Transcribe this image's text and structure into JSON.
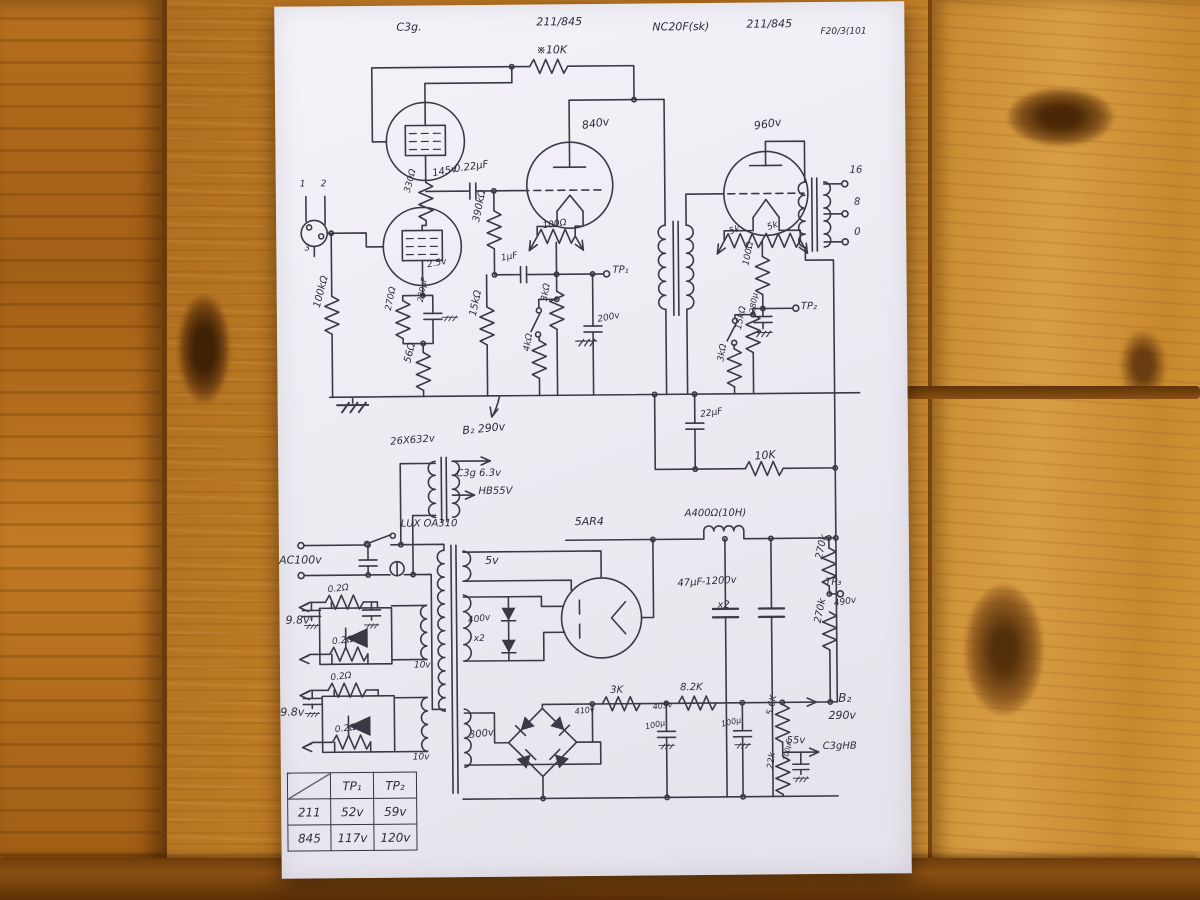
{
  "scene": {
    "description": "hand-drawn tube amplifier schematic on paper on wooden table",
    "wood_color": "#b06c1c",
    "paper_color": "#f2f1f6",
    "ink_color": "#3a3946"
  },
  "schematic": {
    "labels": [
      {
        "t": "C3g.",
        "x": 122,
        "y": 16
      },
      {
        "t": "211/845",
        "x": 262,
        "y": 12
      },
      {
        "t": "NC20F(sk)",
        "x": 378,
        "y": 18
      },
      {
        "t": "211/845",
        "x": 472,
        "y": 16
      },
      {
        "t": "F20/3(101",
        "x": 546,
        "y": 26,
        "s": 9
      },
      {
        "t": "※10K",
        "x": 262,
        "y": 40
      },
      {
        "t": "840v",
        "x": 306,
        "y": 116,
        "r": -8
      },
      {
        "t": "960v",
        "x": 478,
        "y": 118,
        "r": -8
      },
      {
        "t": "16",
        "x": 574,
        "y": 164,
        "s": 10
      },
      {
        "t": "8",
        "x": 578,
        "y": 196,
        "s": 10
      },
      {
        "t": "0",
        "x": 578,
        "y": 226,
        "s": 10
      },
      {
        "t": "330Ω",
        "x": 128,
        "y": 186,
        "r": -75,
        "s": 9
      },
      {
        "t": "145v",
        "x": 156,
        "y": 164,
        "r": -10,
        "s": 10
      },
      {
        "t": "0.22μF",
        "x": 178,
        "y": 160,
        "r": -8,
        "s": 10
      },
      {
        "t": "390kΩ",
        "x": 196,
        "y": 216,
        "r": -78,
        "s": 10
      },
      {
        "t": "1μF",
        "x": 224,
        "y": 250,
        "r": -10,
        "s": 9
      },
      {
        "t": "100Ω",
        "x": 266,
        "y": 218,
        "r": -8,
        "s": 9
      },
      {
        "t": "TP₁",
        "x": 336,
        "y": 262,
        "s": 10
      },
      {
        "t": "2.5v",
        "x": 150,
        "y": 256,
        "r": -10,
        "s": 9
      },
      {
        "t": "270Ω",
        "x": 108,
        "y": 304,
        "r": -78,
        "s": 9
      },
      {
        "t": "220μF",
        "x": 140,
        "y": 296,
        "r": -80,
        "s": 8
      },
      {
        "t": "100kΩ",
        "x": 36,
        "y": 300,
        "r": -75,
        "s": 10
      },
      {
        "t": "56Ω",
        "x": 126,
        "y": 356,
        "r": -75,
        "s": 10
      },
      {
        "t": "15kΩ",
        "x": 192,
        "y": 310,
        "r": -78,
        "s": 10
      },
      {
        "t": "3kΩ",
        "x": 264,
        "y": 296,
        "r": -80,
        "s": 9
      },
      {
        "t": "4kΩ",
        "x": 246,
        "y": 346,
        "r": -80,
        "s": 9
      },
      {
        "t": "200v",
        "x": 320,
        "y": 312,
        "r": -10,
        "s": 9
      },
      {
        "t": "1",
        "x": 24,
        "y": 174,
        "s": 9
      },
      {
        "t": "2",
        "x": 45,
        "y": 174,
        "s": 9
      },
      {
        "t": "3",
        "x": 28,
        "y": 238,
        "s": 9
      },
      {
        "t": "5k",
        "x": 452,
        "y": 226,
        "r": -20,
        "s": 9
      },
      {
        "t": "5k",
        "x": 490,
        "y": 222,
        "r": -20,
        "s": 9
      },
      {
        "t": "100Ω",
        "x": 466,
        "y": 262,
        "r": -78,
        "s": 9
      },
      {
        "t": "TP₂",
        "x": 524,
        "y": 300,
        "s": 10
      },
      {
        "t": "280μ",
        "x": 472,
        "y": 310,
        "r": -82,
        "s": 8
      },
      {
        "t": "3kΩ",
        "x": 440,
        "y": 358,
        "r": -80,
        "s": 9
      },
      {
        "t": "15kΩ",
        "x": 458,
        "y": 326,
        "r": -78,
        "s": 9
      },
      {
        "t": "22μF",
        "x": 422,
        "y": 408,
        "r": -8,
        "s": 9
      },
      {
        "t": "10K",
        "x": 476,
        "y": 448,
        "r": -4,
        "s": 11
      },
      {
        "t": "B₂ 290v",
        "x": 184,
        "y": 420,
        "r": -5,
        "s": 11
      },
      {
        "t": "26X632v",
        "x": 112,
        "y": 432,
        "r": -4,
        "s": 10
      },
      {
        "t": "C3g 6.3v",
        "x": 178,
        "y": 464,
        "s": 10
      },
      {
        "t": "HB55V",
        "x": 200,
        "y": 482,
        "s": 10
      },
      {
        "t": "LUX OA310",
        "x": 122,
        "y": 514,
        "s": 10
      },
      {
        "t": "AC100v",
        "x": 0,
        "y": 548,
        "s": 11
      },
      {
        "t": "5v",
        "x": 206,
        "y": 550,
        "s": 11
      },
      {
        "t": "5AR4",
        "x": 296,
        "y": 512,
        "s": 11
      },
      {
        "t": "A400Ω(10H)",
        "x": 406,
        "y": 506,
        "s": 10
      },
      {
        "t": "47μF-1200v",
        "x": 398,
        "y": 576,
        "r": -3,
        "s": 10
      },
      {
        "t": "x2",
        "x": 438,
        "y": 598,
        "s": 10
      },
      {
        "t": "270k",
        "x": 536,
        "y": 556,
        "r": -78,
        "s": 10
      },
      {
        "t": "TP₃",
        "x": 546,
        "y": 576,
        "s": 10
      },
      {
        "t": "490v",
        "x": 554,
        "y": 598,
        "r": -8,
        "s": 9
      },
      {
        "t": "270k",
        "x": 534,
        "y": 620,
        "r": -78,
        "s": 10
      },
      {
        "t": "400v",
        "x": 188,
        "y": 612,
        "r": -8,
        "s": 9
      },
      {
        "t": "x2",
        "x": 194,
        "y": 630,
        "s": 9
      },
      {
        "t": "0.2Ω",
        "x": 48,
        "y": 580,
        "r": -6,
        "s": 9
      },
      {
        "t": "0.2Ω",
        "x": 52,
        "y": 632,
        "r": -6,
        "s": 9
      },
      {
        "t": "9.8v",
        "x": 6,
        "y": 608,
        "s": 11
      },
      {
        "t": "10v",
        "x": 134,
        "y": 656,
        "s": 9
      },
      {
        "t": "0.2Ω",
        "x": 50,
        "y": 668,
        "r": -6,
        "s": 9
      },
      {
        "t": "0.2Ω",
        "x": 54,
        "y": 720,
        "r": -6,
        "s": 9
      },
      {
        "t": "9.8v",
        "x": 0,
        "y": 700,
        "s": 11
      },
      {
        "t": "10v",
        "x": 132,
        "y": 748,
        "s": 9
      },
      {
        "t": "300v",
        "x": 188,
        "y": 726,
        "r": -6,
        "s": 10
      },
      {
        "t": "410v",
        "x": 294,
        "y": 704,
        "r": -6,
        "s": 8
      },
      {
        "t": "3K",
        "x": 330,
        "y": 682,
        "s": 10
      },
      {
        "t": "405v",
        "x": 372,
        "y": 700,
        "r": -6,
        "s": 8
      },
      {
        "t": "8.2K",
        "x": 400,
        "y": 680,
        "s": 10
      },
      {
        "t": "B₂",
        "x": 558,
        "y": 690,
        "s": 12
      },
      {
        "t": "290v",
        "x": 548,
        "y": 708,
        "s": 11
      },
      {
        "t": "100μ",
        "x": 364,
        "y": 720,
        "r": -12,
        "s": 8
      },
      {
        "t": "100μ",
        "x": 440,
        "y": 718,
        "r": -12,
        "s": 8
      },
      {
        "t": "5.6K",
        "x": 486,
        "y": 712,
        "r": -78,
        "s": 9
      },
      {
        "t": "22k",
        "x": 486,
        "y": 766,
        "r": -82,
        "s": 9
      },
      {
        "t": "55v",
        "x": 506,
        "y": 734,
        "s": 10
      },
      {
        "t": "C3gHB",
        "x": 542,
        "y": 740,
        "s": 10
      },
      {
        "t": "100μF",
        "x": 502,
        "y": 758,
        "r": -80,
        "s": 7
      }
    ],
    "test_point_table": {
      "col_headers": [
        "TP₁",
        "TP₂"
      ],
      "rows": [
        {
          "name": "211",
          "tp1": "52v",
          "tp2": "59v"
        },
        {
          "name": "845",
          "tp1": "117v",
          "tp2": "120v"
        }
      ]
    }
  }
}
